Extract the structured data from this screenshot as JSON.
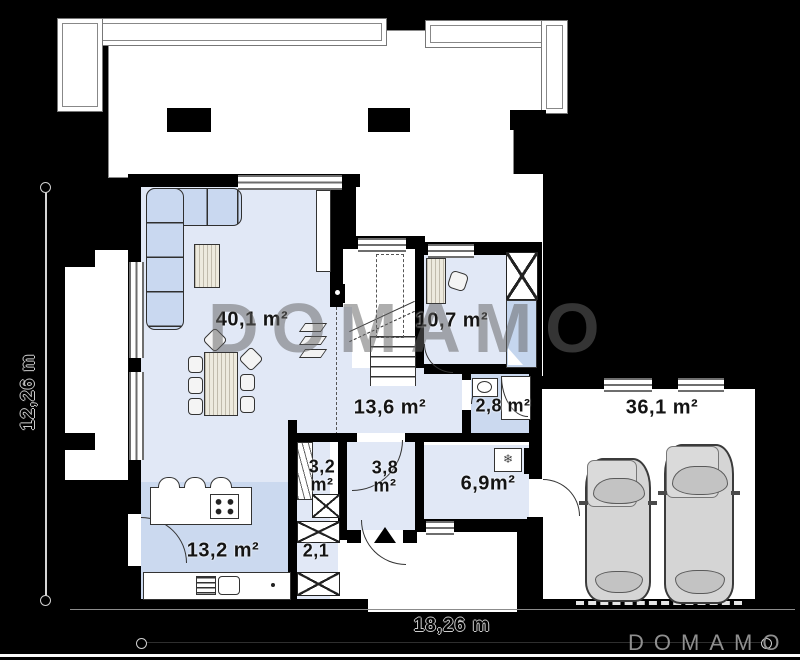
{
  "watermark": "DOMAMO",
  "logo": "DOMAMO",
  "dims": {
    "left": "12,26 m",
    "bottom": "18,26 m"
  },
  "rooms": {
    "living": "40,1 m²",
    "office": "10,7 m²",
    "hall": "13,6 m²",
    "bathroom": "2,8 m²",
    "pantry": "3,2 m²",
    "vestibule": "3,8 m²",
    "utility": "6,9m²",
    "closet": "2,1",
    "kitchen": "13,2 m²",
    "garage": "36,1 m²"
  },
  "icons": {
    "freezer": "❄"
  },
  "colors": {
    "background": "#000000",
    "wall": "#000000",
    "room_fill": "#e1e8f6",
    "room_fill_dark": "#cbd9ef",
    "furniture_blue": "#c9d8f0",
    "watermark_gray": "#646464",
    "logo_gray": "#8f8f8f"
  }
}
